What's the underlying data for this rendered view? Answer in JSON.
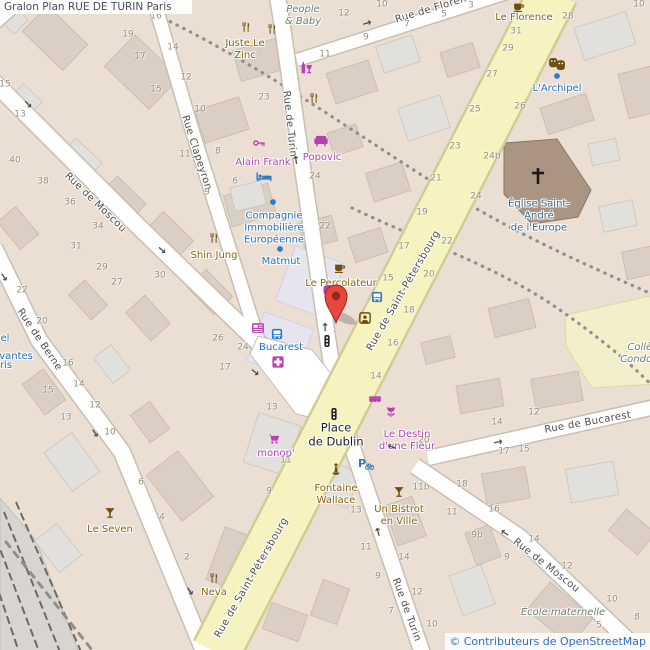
{
  "title": "Gralon Plan RUE DE TURIN Paris",
  "attribution": "© Contributeurs de OpenStreetMap",
  "colors": {
    "land": "#ebdfd3",
    "building": "#dbcfc5",
    "building_light": "#e2e0dc",
    "building_lavender": "#e6e4ee",
    "road": "#ffffff",
    "road_casing": "#c6bfb2",
    "avenue_yellow": "#f7f3c0",
    "school": "#f3efcb",
    "church": "#a99582",
    "marker_red": "#e8453c",
    "poi_brown": "#8c6210",
    "poi_magenta": "#b445b4",
    "poi_blue": "#2071c4",
    "street_text": "#4e4e4e",
    "number_text": "#97907f"
  },
  "map": {
    "street_labels": [
      {
        "text": "Rue de Moscou",
        "x": 95,
        "y": 203,
        "rot": 44
      },
      {
        "text": "Rue Clapeyron",
        "x": 196,
        "y": 153,
        "rot": 72
      },
      {
        "text": "Rue de Turin",
        "x": 289,
        "y": 124,
        "rot": 84
      },
      {
        "text": "Rue de Berne",
        "x": 39,
        "y": 340,
        "rot": 56
      },
      {
        "text": "Rue de Saint-Pétersbourg",
        "x": 404,
        "y": 291,
        "rot": -60
      },
      {
        "text": "Rue de Saint-Pétersbourg",
        "x": 252,
        "y": 578,
        "rot": -60
      },
      {
        "text": "Rue de Turin",
        "x": 406,
        "y": 610,
        "rot": 70
      },
      {
        "text": "Rue de Moscou",
        "x": 546,
        "y": 566,
        "rot": 38
      },
      {
        "text": "Rue de Bucarest",
        "x": 588,
        "y": 423,
        "rot": -10
      },
      {
        "text": "Rue de Florence",
        "x": 437,
        "y": 8,
        "rot": -17
      }
    ],
    "poi_labels": [
      {
        "lines": [
          "Juste Le",
          "Zinc"
        ],
        "x": 245,
        "y": 50,
        "kind": "brown"
      },
      {
        "lines": [
          "Le Florence"
        ],
        "x": 524,
        "y": 18,
        "kind": "brown"
      },
      {
        "lines": [
          "Shin Jung"
        ],
        "x": 214,
        "y": 256,
        "kind": "brown"
      },
      {
        "lines": [
          "Le Percolateur"
        ],
        "x": 341,
        "y": 284,
        "kind": "brown"
      },
      {
        "lines": [
          "Le Seven"
        ],
        "x": 110,
        "y": 530,
        "kind": "brown"
      },
      {
        "lines": [
          "Neva"
        ],
        "x": 214,
        "y": 593,
        "kind": "brown"
      },
      {
        "lines": [
          "Un Bistrot",
          "en Ville"
        ],
        "x": 399,
        "y": 516,
        "kind": "brown"
      },
      {
        "lines": [
          "Fontaine",
          "Wallace"
        ],
        "x": 336,
        "y": 495,
        "kind": "brown"
      },
      {
        "lines": [
          "Alain Frank"
        ],
        "x": 263,
        "y": 163,
        "kind": "magenta"
      },
      {
        "lines": [
          "Popovic"
        ],
        "x": 322,
        "y": 158,
        "kind": "magenta"
      },
      {
        "lines": [
          "monop'"
        ],
        "x": 276,
        "y": 454,
        "kind": "magenta"
      },
      {
        "lines": [
          "Le Destin",
          "d'une Fleur"
        ],
        "x": 407,
        "y": 441,
        "kind": "magenta"
      },
      {
        "lines": [
          "L'Archipel"
        ],
        "x": 557,
        "y": 89,
        "kind": "blue"
      },
      {
        "lines": [
          "Compagnie",
          "Immobilière",
          "Européenne"
        ],
        "x": 274,
        "y": 228,
        "kind": "blue"
      },
      {
        "lines": [
          "Matmut"
        ],
        "x": 281,
        "y": 262,
        "kind": "blue"
      },
      {
        "lines": [
          "Bucarest"
        ],
        "x": 281,
        "y": 348,
        "kind": "blue"
      },
      {
        "lines": [
          "el"
        ],
        "x": 5,
        "y": 339,
        "kind": "blue"
      },
      {
        "lines": [
          "rvantes"
        ],
        "x": 14,
        "y": 357,
        "kind": "blue"
      },
      {
        "lines": [
          "ris"
        ],
        "x": 6,
        "y": 366,
        "kind": "blue"
      },
      {
        "lines": [
          "Église Saint-",
          "André",
          "de l'Europe"
        ],
        "x": 539,
        "y": 216,
        "kind": "church"
      },
      {
        "lines": [
          "People",
          "& Baby"
        ],
        "x": 303,
        "y": 16,
        "kind": "area"
      },
      {
        "lines": [
          "École maternelle"
        ],
        "x": 563,
        "y": 613,
        "kind": "area"
      },
      {
        "lines": [
          "Collège",
          "Condorcet"
        ],
        "x": 646,
        "y": 354,
        "kind": "area"
      },
      {
        "lines": [
          "Place",
          "de Dublin"
        ],
        "x": 336,
        "y": 435,
        "kind": "black"
      }
    ],
    "house_numbers": [
      {
        "text": "16",
        "x": 156,
        "y": 17
      },
      {
        "text": "19",
        "x": 128,
        "y": 35
      },
      {
        "text": "14",
        "x": 173,
        "y": 48
      },
      {
        "text": "17",
        "x": 140,
        "y": 57
      },
      {
        "text": "12",
        "x": 186,
        "y": 78
      },
      {
        "text": "15",
        "x": 156,
        "y": 90
      },
      {
        "text": "10",
        "x": 200,
        "y": 110
      },
      {
        "text": "11",
        "x": 185,
        "y": 155
      },
      {
        "text": "8",
        "x": 218,
        "y": 152
      },
      {
        "text": "9",
        "x": 207,
        "y": 193
      },
      {
        "text": "6",
        "x": 235,
        "y": 182
      },
      {
        "text": "15",
        "x": 5,
        "y": 85
      },
      {
        "text": "13",
        "x": 20,
        "y": 115
      },
      {
        "text": "40",
        "x": 15,
        "y": 161
      },
      {
        "text": "38",
        "x": 43,
        "y": 182
      },
      {
        "text": "36",
        "x": 70,
        "y": 203
      },
      {
        "text": "34",
        "x": 98,
        "y": 227
      },
      {
        "text": "31",
        "x": 76,
        "y": 247
      },
      {
        "text": "29",
        "x": 102,
        "y": 268
      },
      {
        "text": "30",
        "x": 160,
        "y": 276
      },
      {
        "text": "27",
        "x": 117,
        "y": 283
      },
      {
        "text": "26",
        "x": 218,
        "y": 339
      },
      {
        "text": "24",
        "x": 243,
        "y": 348
      },
      {
        "text": "17",
        "x": 225,
        "y": 368
      },
      {
        "text": "22",
        "x": 22,
        "y": 291
      },
      {
        "text": "20",
        "x": 42,
        "y": 322
      },
      {
        "text": "16",
        "x": 68,
        "y": 364
      },
      {
        "text": "15",
        "x": 48,
        "y": 391
      },
      {
        "text": "14",
        "x": 79,
        "y": 385
      },
      {
        "text": "13",
        "x": 66,
        "y": 418
      },
      {
        "text": "12",
        "x": 95,
        "y": 406
      },
      {
        "text": "10",
        "x": 110,
        "y": 433
      },
      {
        "text": "6",
        "x": 141,
        "y": 483
      },
      {
        "text": "4",
        "x": 162,
        "y": 518
      },
      {
        "text": "2",
        "x": 187,
        "y": 558
      },
      {
        "text": "23",
        "x": 264,
        "y": 98
      },
      {
        "text": "24",
        "x": 315,
        "y": 177
      },
      {
        "text": "22",
        "x": 325,
        "y": 227
      },
      {
        "text": "12",
        "x": 344,
        "y": 14
      },
      {
        "text": "10",
        "x": 382,
        "y": 5
      },
      {
        "text": "11",
        "x": 325,
        "y": 55
      },
      {
        "text": "9",
        "x": 366,
        "y": 38
      },
      {
        "text": "7",
        "x": 407,
        "y": 25
      },
      {
        "text": "5",
        "x": 444,
        "y": 15
      },
      {
        "text": "3",
        "x": 471,
        "y": 6
      },
      {
        "text": "10",
        "x": 639,
        "y": 5
      },
      {
        "text": "28",
        "x": 568,
        "y": 17
      },
      {
        "text": "31",
        "x": 516,
        "y": 32
      },
      {
        "text": "29",
        "x": 508,
        "y": 49
      },
      {
        "text": "27",
        "x": 492,
        "y": 75
      },
      {
        "text": "25",
        "x": 475,
        "y": 110
      },
      {
        "text": "23",
        "x": 455,
        "y": 147
      },
      {
        "text": "21",
        "x": 436,
        "y": 179
      },
      {
        "text": "19",
        "x": 422,
        "y": 213
      },
      {
        "text": "17",
        "x": 404,
        "y": 247
      },
      {
        "text": "15",
        "x": 388,
        "y": 279
      },
      {
        "text": "26",
        "x": 520,
        "y": 107
      },
      {
        "text": "24b",
        "x": 492,
        "y": 157
      },
      {
        "text": "24",
        "x": 476,
        "y": 197
      },
      {
        "text": "22",
        "x": 447,
        "y": 242
      },
      {
        "text": "20",
        "x": 429,
        "y": 275
      },
      {
        "text": "18",
        "x": 409,
        "y": 311
      },
      {
        "text": "16",
        "x": 393,
        "y": 344
      },
      {
        "text": "14",
        "x": 376,
        "y": 377
      },
      {
        "text": "13",
        "x": 272,
        "y": 408
      },
      {
        "text": "11",
        "x": 286,
        "y": 461
      },
      {
        "text": "9",
        "x": 269,
        "y": 492
      },
      {
        "text": "20",
        "x": 424,
        "y": 441
      },
      {
        "text": "11b",
        "x": 421,
        "y": 488
      },
      {
        "text": "13",
        "x": 356,
        "y": 511
      },
      {
        "text": "11",
        "x": 366,
        "y": 548
      },
      {
        "text": "9",
        "x": 378,
        "y": 577
      },
      {
        "text": "7",
        "x": 391,
        "y": 612
      },
      {
        "text": "14",
        "x": 404,
        "y": 558
      },
      {
        "text": "12",
        "x": 417,
        "y": 593
      },
      {
        "text": "10",
        "x": 432,
        "y": 625
      },
      {
        "text": "18",
        "x": 462,
        "y": 485
      },
      {
        "text": "16",
        "x": 494,
        "y": 510
      },
      {
        "text": "14",
        "x": 534,
        "y": 540
      },
      {
        "text": "12",
        "x": 567,
        "y": 567
      },
      {
        "text": "10",
        "x": 612,
        "y": 600
      },
      {
        "text": "8",
        "x": 637,
        "y": 618
      },
      {
        "text": "11",
        "x": 452,
        "y": 513
      },
      {
        "text": "9b",
        "x": 477,
        "y": 536
      },
      {
        "text": "9",
        "x": 507,
        "y": 558
      },
      {
        "text": "5",
        "x": 599,
        "y": 626
      },
      {
        "text": "14",
        "x": 497,
        "y": 423
      },
      {
        "text": "12",
        "x": 534,
        "y": 413
      },
      {
        "text": "17",
        "x": 504,
        "y": 452
      },
      {
        "text": "15",
        "x": 524,
        "y": 450
      }
    ],
    "icons": [
      {
        "name": "restaurant",
        "x": 246,
        "y": 27
      },
      {
        "name": "restaurant",
        "x": 272,
        "y": 29
      },
      {
        "name": "restaurant",
        "x": 314,
        "y": 98
      },
      {
        "name": "restaurant",
        "x": 214,
        "y": 238
      },
      {
        "name": "restaurant",
        "x": 214,
        "y": 578
      },
      {
        "name": "cocktail",
        "x": 110,
        "y": 513
      },
      {
        "name": "cocktail",
        "x": 399,
        "y": 492
      },
      {
        "name": "coffee",
        "x": 519,
        "y": 7
      },
      {
        "name": "coffee",
        "x": 340,
        "y": 268
      },
      {
        "name": "bar",
        "x": 306,
        "y": 68
      },
      {
        "name": "masks",
        "x": 557,
        "y": 64
      },
      {
        "name": "dot",
        "x": 557,
        "y": 76
      },
      {
        "name": "dot",
        "x": 273,
        "y": 202
      },
      {
        "name": "dot",
        "x": 280,
        "y": 249
      },
      {
        "name": "key",
        "x": 259,
        "y": 143
      },
      {
        "name": "sofa",
        "x": 321,
        "y": 141
      },
      {
        "name": "bed",
        "x": 264,
        "y": 177
      },
      {
        "name": "bus",
        "x": 377,
        "y": 297
      },
      {
        "name": "bus",
        "x": 277,
        "y": 334
      },
      {
        "name": "news",
        "x": 258,
        "y": 328
      },
      {
        "name": "pharmacy",
        "x": 278,
        "y": 362
      },
      {
        "name": "booth",
        "x": 365,
        "y": 318
      },
      {
        "name": "cart",
        "x": 274,
        "y": 439
      },
      {
        "name": "awning",
        "x": 375,
        "y": 400
      },
      {
        "name": "flower",
        "x": 391,
        "y": 412
      },
      {
        "name": "statue",
        "x": 336,
        "y": 469
      },
      {
        "name": "pbike",
        "x": 366,
        "y": 464
      },
      {
        "name": "tlight",
        "x": 327,
        "y": 341
      },
      {
        "name": "tlight",
        "x": 334,
        "y": 414
      },
      {
        "name": "shopdot",
        "x": 328,
        "y": 290
      },
      {
        "name": "cross",
        "x": 538,
        "y": 176
      }
    ],
    "arrows": [
      {
        "x": 28,
        "y": 104,
        "rot": 45
      },
      {
        "x": 162,
        "y": 250,
        "rot": 42
      },
      {
        "x": 255,
        "y": 372,
        "rot": 40
      },
      {
        "x": 4,
        "y": 277,
        "rot": 56
      },
      {
        "x": 95,
        "y": 433,
        "rot": 56
      },
      {
        "x": 190,
        "y": 591,
        "rot": 56
      },
      {
        "x": 367,
        "y": 23,
        "rot": -17
      },
      {
        "x": 325,
        "y": 327,
        "rot": -90
      },
      {
        "x": 296,
        "y": 160,
        "rot": -97
      },
      {
        "x": 378,
        "y": 532,
        "rot": -105
      },
      {
        "x": 505,
        "y": 533,
        "rot": -145
      },
      {
        "x": 498,
        "y": 442,
        "rot": -10
      },
      {
        "x": 392,
        "y": 447,
        "rot": -160
      }
    ]
  }
}
